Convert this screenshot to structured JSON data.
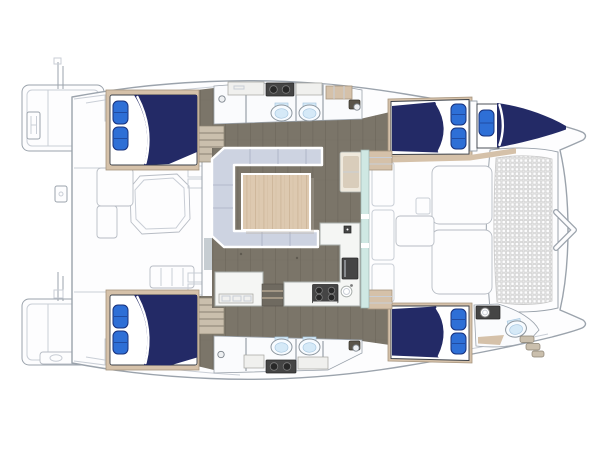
{
  "diagram": {
    "type": "floorplan",
    "subject": "sailing-catamaran-deck-and-accommodation-plan",
    "orientation": {
      "bow": "right",
      "stern": "left"
    },
    "areas": [
      "swim-platform-top",
      "swim-platform-bottom",
      "aft-cockpit",
      "salon",
      "galley",
      "foredeck",
      "trampoline",
      "aft-cabin-top",
      "aft-cabin-bottom",
      "forward-cabin-top",
      "forward-cabin-bottom",
      "bow-berth",
      "bow-head",
      "head-top-aft",
      "head-top-forward",
      "head-bottom-aft",
      "head-bottom-forward"
    ],
    "counts": {
      "double_berths": 4,
      "bow_berths": 1,
      "pillows": 9,
      "toilets": 5,
      "vanity_basins": 5,
      "galley_sinks": 1,
      "stove_burners": 4,
      "tables": 2
    }
  },
  "colors": {
    "hull_fill": "#fdfdfe",
    "hull_line": "#9ba3ac",
    "hull_detail": "#c9ced6",
    "panel_line": "#b7bcc4",
    "floor": "#7b7569",
    "floor_seam": "#5f5a50",
    "frame_tan": "#d5c1a9",
    "tan_line": "#a6947d",
    "sheet": "#ffffff",
    "mattress_line": "#3a4049",
    "bed_navy": "#232a66",
    "pillow_blue": "#2e6fd6",
    "pillow_edge": "#17307b",
    "head_floor": "#fafbfd",
    "wall_line": "#8f98a1",
    "porcelain": "#f7fbff",
    "porcelain_line": "#8e979f",
    "toilet_lid": "#d5e9f7",
    "toilet_lid_line": "#a9c8e0",
    "appliance": "#454545",
    "appliance_dark": "#282828",
    "basin_ring": "#7c7c7c",
    "cabinet": "#f0f0ee",
    "cabinet_line": "#a3a39d",
    "settee": "#cdd3e1",
    "settee_line": "#a9b0c3",
    "wood": "#ddc9b0",
    "wood_grain": "#c8b092",
    "glass": "#cfe8e3",
    "glass_line": "#9fb6b2",
    "counter": "#f5f6f4",
    "counter_line": "#a9afac",
    "steps": "#cabfad",
    "steps_line": "#8b8273",
    "mesh_bg": "#efefef",
    "mesh_dot": "#c8c8c8",
    "screw_fill": "#eef0f2",
    "screw_line": "#7b838b",
    "hatch": "#5a5449",
    "hatch_line": "#39352c",
    "door": "#c6cdd2",
    "shelf": "#6f6a60",
    "shelf_edge": "#55514a",
    "chaise_base": "#efe9dd",
    "chaise_cushion": "#d9cdbb",
    "shadow": "#b9b3a6"
  }
}
